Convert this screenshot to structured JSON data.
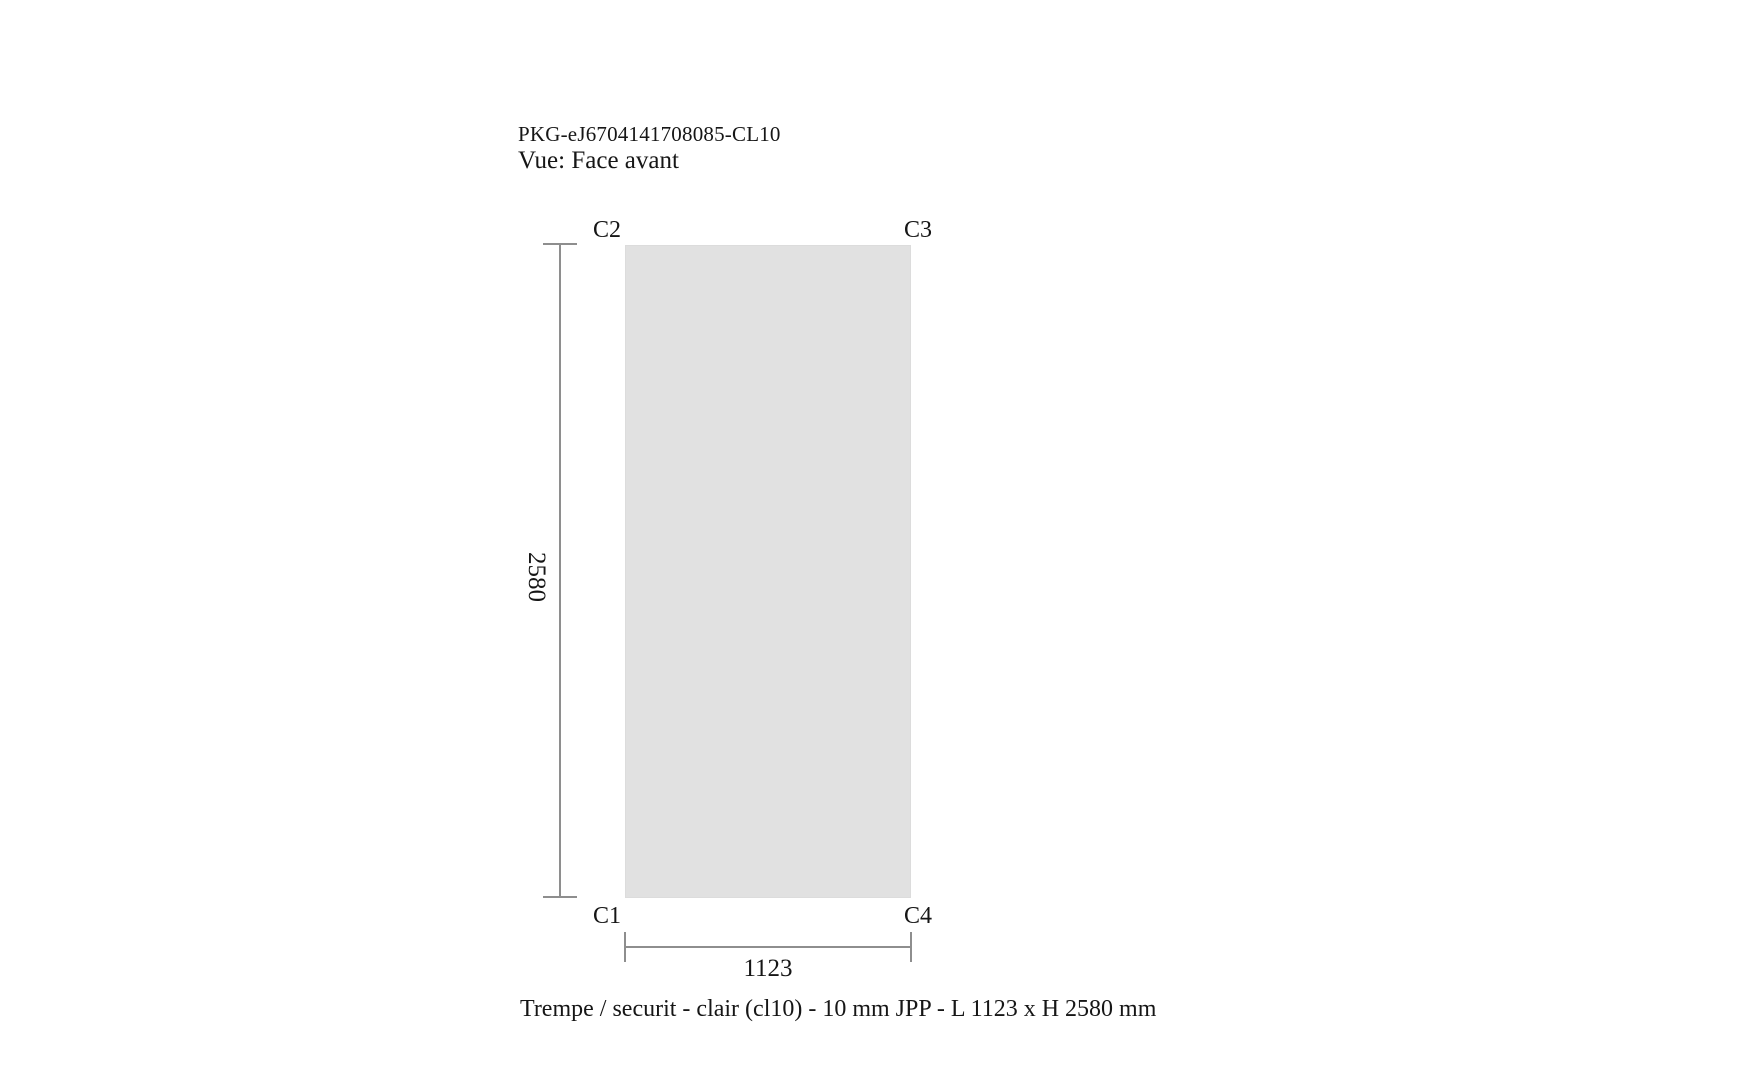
{
  "header": {
    "reference": "PKG-eJ6704141708085-CL10",
    "view_label": "Vue: Face avant"
  },
  "drawing": {
    "corner_labels": {
      "top_left": "C2",
      "top_right": "C3",
      "bottom_left": "C1",
      "bottom_right": "C4"
    },
    "height_dimension": "2580",
    "width_dimension": "1123",
    "panel_fill_color": "#e1e1e1",
    "dimension_line_color": "#8e8e8e",
    "text_color": "#161616"
  },
  "footer": {
    "description": "Trempe / securit - clair (cl10) - 10 mm JPP - L 1123 x H 2580 mm"
  }
}
